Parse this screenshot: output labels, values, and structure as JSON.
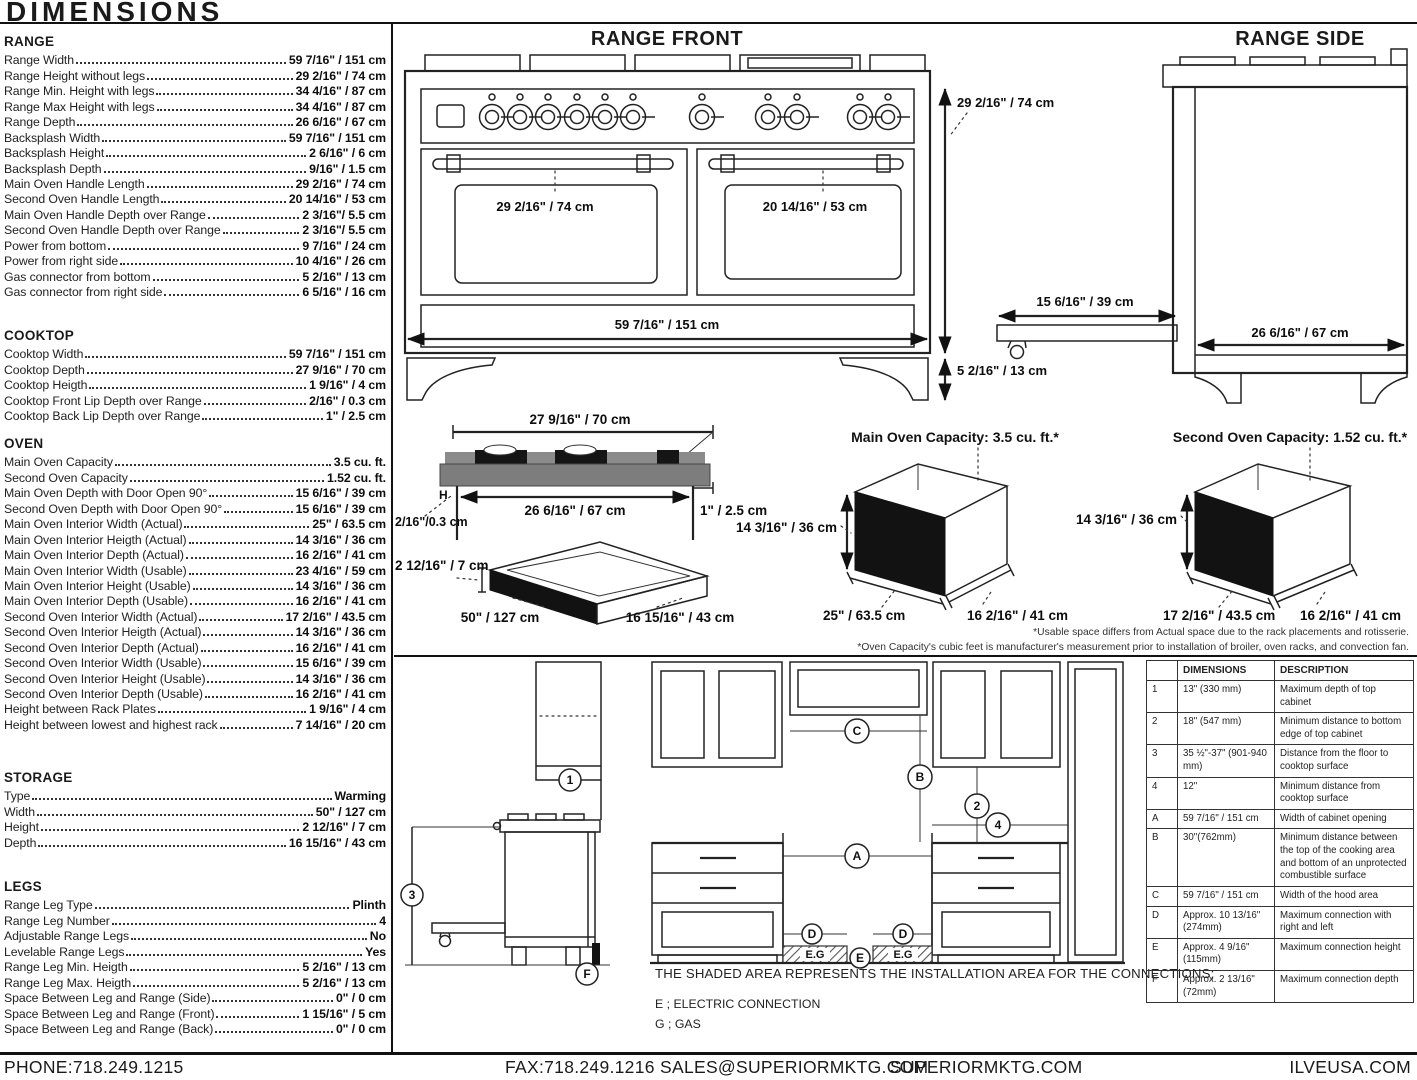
{
  "page": {
    "title": "DIMENSIONS"
  },
  "footer": {
    "phone": "PHONE:718.249.1215",
    "fax": "FAX:718.249.1216",
    "email": "SALES@SUPERIORMKTG.COM",
    "website": "SUPERIORMKTG.COM",
    "brand_site": "ILVEUSA.COM"
  },
  "specs": {
    "range": {
      "name": "RANGE",
      "rows": [
        {
          "label": "Range Width",
          "value": "59 7/16\" / 151 cm"
        },
        {
          "label": "Range Height without legs",
          "value": "29 2/16\" / 74 cm"
        },
        {
          "label": "Range Min. Height with legs",
          "value": "34 4/16\" / 87 cm"
        },
        {
          "label": "Range Max Height with legs",
          "value": "34 4/16\" / 87 cm"
        },
        {
          "label": "Range Depth",
          "value": "26 6/16\" / 67 cm"
        },
        {
          "label": "Backsplash Width",
          "value": "59 7/16\" / 151 cm"
        },
        {
          "label": "Backsplash Height",
          "value": "2 6/16\" / 6 cm"
        },
        {
          "label": "Backsplash Depth",
          "value": "9/16\" / 1.5 cm"
        },
        {
          "label": "Main Oven Handle Length",
          "value": "29 2/16\" / 74 cm"
        },
        {
          "label": "Second Oven Handle Length",
          "value": "20 14/16\" / 53 cm"
        },
        {
          "label": "Main Oven Handle Depth over Range",
          "value": "2 3/16\"/ 5.5 cm"
        },
        {
          "label": "Second Oven Handle Depth over Range",
          "value": "2 3/16\"/ 5.5 cm"
        },
        {
          "label": "Power from bottom",
          "value": "9 7/16\" / 24 cm"
        },
        {
          "label": "Power from right side",
          "value": "10 4/16\" / 26 cm"
        },
        {
          "label": "Gas connector from bottom",
          "value": "5 2/16\" / 13 cm"
        },
        {
          "label": "Gas connector from right side",
          "value": "6 5/16\" / 16 cm"
        }
      ]
    },
    "cooktop": {
      "name": "COOKTOP",
      "rows": [
        {
          "label": "Cooktop Width",
          "value": "59 7/16\" / 151 cm"
        },
        {
          "label": "Cooktop Depth",
          "value": "27 9/16\" / 70 cm"
        },
        {
          "label": "Cooktop Heigth",
          "value": "1 9/16\" / 4 cm"
        },
        {
          "label": "Cooktop Front Lip Depth over Range",
          "value": "2/16\" / 0.3 cm"
        },
        {
          "label": "Cooktop Back Lip Depth over Range",
          "value": "1\" / 2.5 cm"
        }
      ]
    },
    "oven": {
      "name": "OVEN",
      "rows": [
        {
          "label": "Main Oven Capacity",
          "value": "3.5 cu. ft."
        },
        {
          "label": "Second Oven Capacity",
          "value": "1.52 cu. ft."
        },
        {
          "label": "Main Oven Depth with Door Open 90°",
          "value": "15 6/16\" / 39 cm"
        },
        {
          "label": "Second Oven Depth with Door Open 90°",
          "value": "15 6/16\" / 39 cm"
        },
        {
          "label": "Main Oven Interior Width (Actual)",
          "value": "25\" / 63.5 cm"
        },
        {
          "label": "Main Oven Interior Heigth (Actual)",
          "value": "14 3/16\" / 36 cm"
        },
        {
          "label": "Main Oven Interior Depth (Actual)",
          "value": "16 2/16\" / 41 cm"
        },
        {
          "label": "Main Oven Interior Width (Usable)",
          "value": "23 4/16\" / 59 cm"
        },
        {
          "label": "Main Oven Interior Height (Usable)",
          "value": "14 3/16\" / 36 cm"
        },
        {
          "label": "Main Oven Interior Depth (Usable)",
          "value": "16 2/16\" / 41 cm"
        },
        {
          "label": "Second Oven Interior Width (Actual)",
          "value": "17 2/16\" / 43.5 cm"
        },
        {
          "label": "Second Oven Interior Heigth (Actual)",
          "value": "14 3/16\" / 36 cm"
        },
        {
          "label": "Second Oven Interior Depth (Actual)",
          "value": "16 2/16\" / 41 cm"
        },
        {
          "label": "Second Oven Interior Width (Usable)",
          "value": "15 6/16\" / 39 cm"
        },
        {
          "label": "Second Oven Interior Height (Usable)",
          "value": "14 3/16\" / 36 cm"
        },
        {
          "label": "Second Oven Interior Depth (Usable)",
          "value": "16 2/16\" / 41 cm"
        },
        {
          "label": "Height between Rack Plates",
          "value": "1 9/16\" / 4 cm"
        },
        {
          "label": "Height between lowest and highest rack",
          "value": "7 14/16\" / 20 cm"
        }
      ]
    },
    "storage": {
      "name": "STORAGE",
      "rows": [
        {
          "label": "Type",
          "value": "Warming"
        },
        {
          "label": "Width",
          "value": "50\" / 127 cm"
        },
        {
          "label": "Height",
          "value": "2 12/16\" / 7 cm"
        },
        {
          "label": "Depth",
          "value": "16 15/16\" / 43 cm"
        }
      ]
    },
    "legs": {
      "name": "LEGS",
      "rows": [
        {
          "label": "Range Leg Type",
          "value": "Plinth"
        },
        {
          "label": "Range Leg Number",
          "value": "4"
        },
        {
          "label": "Adjustable Range Legs",
          "value": "No"
        },
        {
          "label": "Levelable Range Legs",
          "value": "Yes"
        },
        {
          "label": "Range Leg Min. Heigth",
          "value": "5 2/16\" / 13 cm"
        },
        {
          "label": "Range Leg Max. Heigth",
          "value": "5 2/16\" / 13 cm"
        },
        {
          "label": "Space Between Leg and Range (Side)",
          "value": "0\" / 0 cm"
        },
        {
          "label": "Space Between Leg and Range (Front)",
          "value": "1 15/16\" / 5 cm"
        },
        {
          "label": "Space Between Leg and Range (Back)",
          "value": "0\" / 0 cm"
        }
      ]
    }
  },
  "front": {
    "title": "RANGE FRONT",
    "main_handle": "29 2/16\" / 74 cm",
    "second_handle": "20 14/16\" / 53 cm",
    "width": "59 7/16\" / 151 cm",
    "height": "29 2/16\" / 74 cm",
    "leg_height": "5 2/16\" / 13 cm"
  },
  "side": {
    "title": "RANGE SIDE",
    "depth": "26 6/16\" / 67 cm",
    "drawer_extension": "15 6/16\" / 39 cm"
  },
  "cooktop_profile": {
    "width": "27 9/16\" / 70 cm",
    "usable": "26 6/16\" / 67 cm",
    "back_lip": "1\" / 2.5 cm",
    "front_lip": "2/16\"/0.3 cm",
    "h_label": "H"
  },
  "storage_drawer": {
    "height": "2 12/16\" / 7 cm",
    "width": "50\" / 127 cm",
    "depth": "16 15/16\" / 43 cm"
  },
  "main_oven": {
    "title": "Main Oven Capacity: 3.5 cu. ft.*",
    "height": "14 3/16\" / 36 cm",
    "width": "25\" / 63.5 cm",
    "depth": "16 2/16\" / 41 cm"
  },
  "second_oven": {
    "title": "Second Oven Capacity: 1.52 cu. ft.*",
    "height": "14 3/16\" / 36 cm",
    "width": "17 2/16\" / 43.5 cm",
    "depth": "16 2/16\" / 41 cm"
  },
  "footnotes": {
    "line1": "*Usable space differs from Actual space due to the rack placements and rotisserie.",
    "line2": "*Oven Capacity's cubic feet is manufacturer's measurement prior to installation of broiler, oven racks, and convection fan."
  },
  "installation": {
    "note": "THE SHADED AREA REPRESENTS THE INSTALLATION AREA FOR THE CONNECTIONS;",
    "legend_electric": "E ; ELECTRIC CONNECTION",
    "legend_gas": "G ; GAS",
    "hatch_label": "E.G",
    "markers": {
      "n1": "1",
      "n2": "2",
      "n3": "3",
      "n4": "4",
      "a": "A",
      "b": "B",
      "c": "C",
      "d": "D",
      "e": "E",
      "f": "F"
    },
    "table": {
      "headers": [
        "",
        "DIMENSIONS",
        "DESCRIPTION"
      ],
      "rows": [
        {
          "id": "1",
          "dim": "13\" (330 mm)",
          "desc": "Maximum depth of top cabinet"
        },
        {
          "id": "2",
          "dim": "18\" (547 mm)",
          "desc": "Minimum distance to bottom edge of top cabinet"
        },
        {
          "id": "3",
          "dim": "35 ½\"-37\" (901-940 mm)",
          "desc": "Distance from the floor to cooktop surface"
        },
        {
          "id": "4",
          "dim": "12\"",
          "desc": "Minimum distance from cooktop surface"
        },
        {
          "id": "A",
          "dim": "59 7/16\" / 151 cm",
          "desc": "Width of cabinet opening"
        },
        {
          "id": "B",
          "dim": "30\"(762mm)",
          "desc": "Minimum distance between the top of the cooking area and bottom of an unprotected combustible surface"
        },
        {
          "id": "C",
          "dim": "59 7/16\" / 151 cm",
          "desc": "Width of the hood area"
        },
        {
          "id": "D",
          "dim": "Approx. 10 13/16\" (274mm)",
          "desc": "Maximum connection with right and left"
        },
        {
          "id": "E",
          "dim": "Approx. 4 9/16\" (115mm)",
          "desc": "Maximum connection height"
        },
        {
          "id": "F",
          "dim": "Approx. 2 13/16\" (72mm)",
          "desc": "Maximum connection depth"
        }
      ]
    }
  }
}
